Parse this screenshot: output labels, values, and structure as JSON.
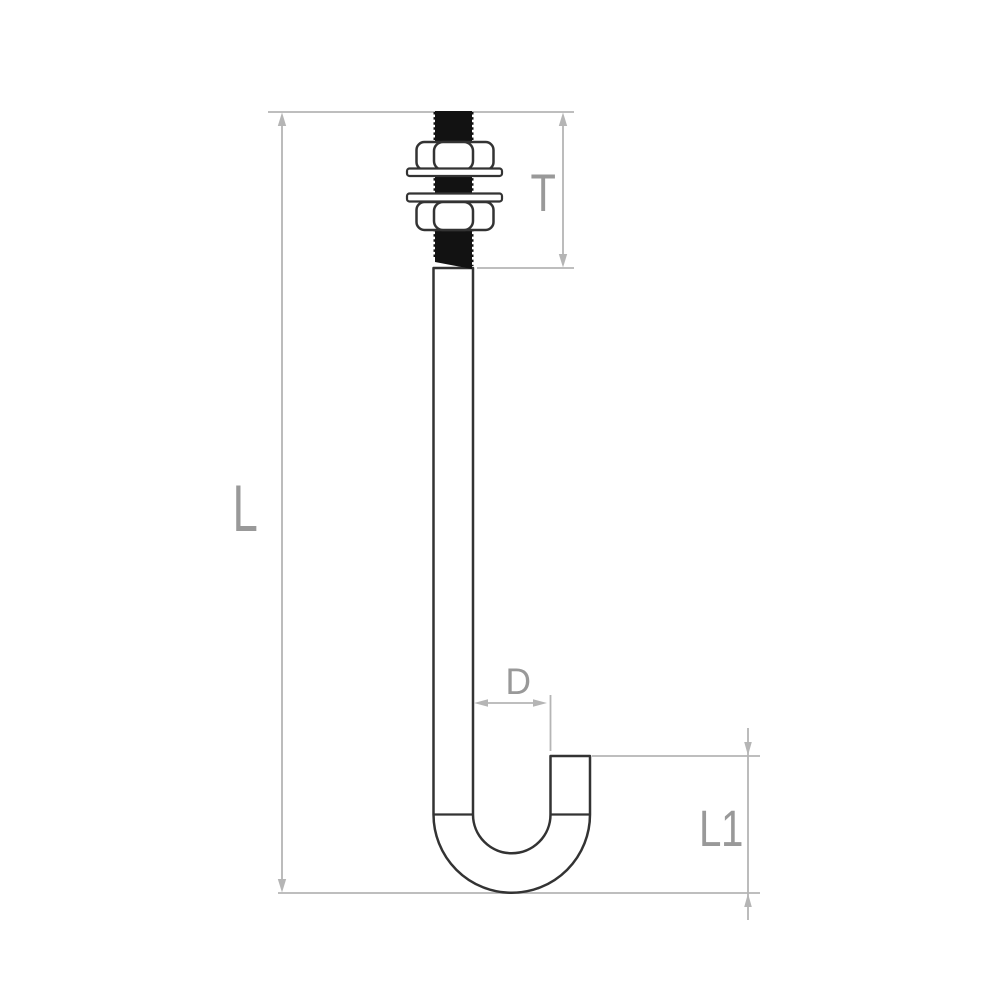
{
  "drawing": {
    "subject": "J-hook bolt with two hex nuts and two washers, shown with dimension lines"
  },
  "dimension_labels": {
    "overall_length": "L",
    "thread_length": "T",
    "rod_diameter": "D",
    "hook_height": "L1"
  },
  "colors": {
    "background": "#ffffff",
    "bolt_outline": "#333333",
    "thread_fill": "#121212",
    "part_fill": "#ffffff",
    "dimension_line": "#b5b5b5",
    "dimension_label": "#999999"
  }
}
